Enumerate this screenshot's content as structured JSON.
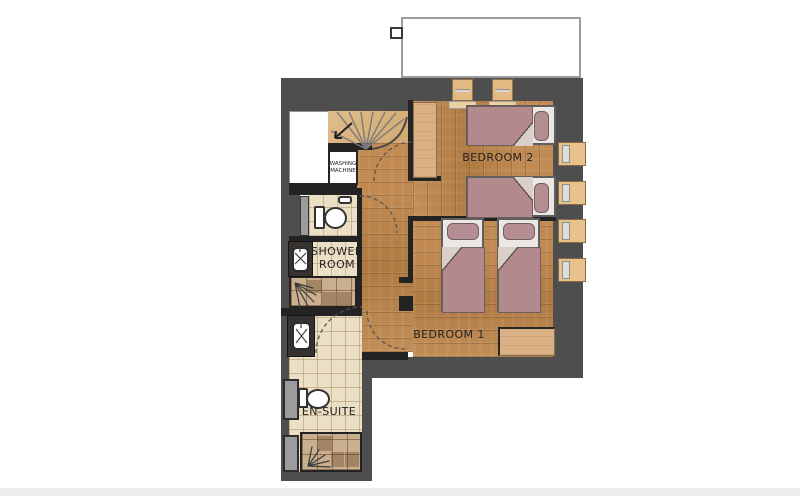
{
  "floor_plan": {
    "labels": {
      "bedroom_2": "BEDROOM 2",
      "bedroom_1": "BEDROOM 1",
      "shower_room": [
        "SHOWER",
        "ROOM"
      ],
      "en_suite": "EN-SUITE",
      "washing_machine": [
        "WASHING",
        "MACHINE"
      ]
    },
    "rooms": [
      {
        "name": "Bedroom 2",
        "label": "BEDROOM 2",
        "fixtures": [
          "single-bed",
          "single-bed",
          "wardrobe",
          "balcony-door",
          "balcony-door",
          "window",
          "window"
        ]
      },
      {
        "name": "Bedroom 1",
        "label": "BEDROOM 1",
        "fixtures": [
          "single-bed",
          "single-bed",
          "wardrobe",
          "window",
          "window"
        ]
      },
      {
        "name": "Shower Room",
        "label": "SHOWER ROOM",
        "fixtures": [
          "toilet",
          "sink",
          "shower"
        ]
      },
      {
        "name": "En-Suite",
        "label": "EN-SUITE",
        "fixtures": [
          "toilet",
          "sink",
          "shower"
        ]
      },
      {
        "name": "Stair hall",
        "label": "",
        "fixtures": [
          "winder-staircase",
          "washing-machine",
          "storage-room"
        ]
      }
    ],
    "colors": {
      "background": "#ffffff",
      "wall": "#4e4e4e",
      "partition": "#232323",
      "wood_floor": "#bc8347",
      "wood_light": "#d9b184",
      "stairs": "#dcb277",
      "tile": "#ebdfc6",
      "shower_tile": "#c9af8d",
      "bed_duvet": "#b28a8e",
      "bed_pillow": "#b58e93",
      "bed_frame": "#ece7e2",
      "window_frame": "#e8c28b",
      "glass": "#9c9c9c",
      "vanity": "#35322f",
      "label_text": "#222222"
    }
  }
}
